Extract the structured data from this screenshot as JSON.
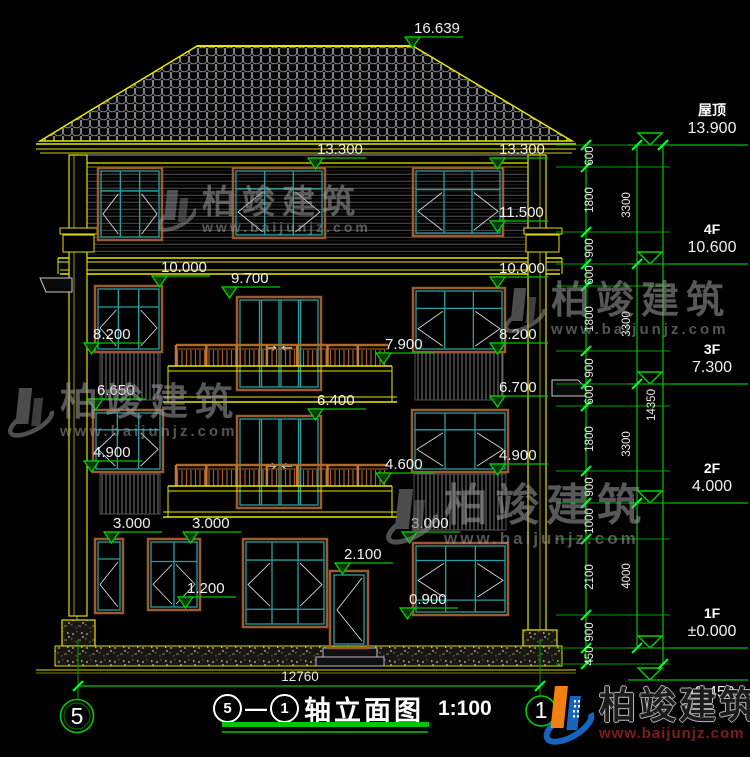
{
  "page": {
    "background": "#000000"
  },
  "title": {
    "axis_from": "5",
    "axis_to": "1",
    "separator": "—",
    "name": "轴立面图",
    "scale": "1:100"
  },
  "watermark": {
    "brand": "柏竣建筑",
    "url": "www.baijunjz.com"
  },
  "footer_logo": {
    "brand": "柏竣建筑",
    "url": "www.baijunjz.com"
  },
  "colors": {
    "dimension_green": "#00c400",
    "outline_yellow": "#e8e800",
    "window_teal": "#28a0a0",
    "frame_brown": "#9c5a30",
    "railing_brown": "#b06a28",
    "text_white": "#f0f0f0"
  },
  "drawing": {
    "bottom_dim": "12760",
    "axis_bubbles": {
      "left": "5",
      "right": "1"
    },
    "elevation_marks": [
      {
        "label": "16.639",
        "x": 405,
        "y": 37
      },
      {
        "label": "13.300",
        "x": 308,
        "y": 158
      },
      {
        "label": "13.300",
        "x": 490,
        "y": 158
      },
      {
        "label": "11.500",
        "x": 490,
        "y": 221
      },
      {
        "label": "10.000",
        "x": 152,
        "y": 276
      },
      {
        "label": "10.000",
        "x": 490,
        "y": 277
      },
      {
        "label": "9.700",
        "x": 222,
        "y": 287
      },
      {
        "label": "8.200",
        "x": 84,
        "y": 343
      },
      {
        "label": "8.200",
        "x": 490,
        "y": 343
      },
      {
        "label": "7.900",
        "x": 376,
        "y": 353
      },
      {
        "label": "6.650",
        "x": 88,
        "y": 399
      },
      {
        "label": "6.700",
        "x": 490,
        "y": 396
      },
      {
        "label": "6.400",
        "x": 308,
        "y": 409
      },
      {
        "label": "4.900",
        "x": 84,
        "y": 461
      },
      {
        "label": "4.600",
        "x": 376,
        "y": 473
      },
      {
        "label": "4.900",
        "x": 490,
        "y": 464
      },
      {
        "label": "3.000",
        "x": 104,
        "y": 532
      },
      {
        "label": "3.000",
        "x": 183,
        "y": 532
      },
      {
        "label": "3.000",
        "x": 402,
        "y": 532
      },
      {
        "label": "2.100",
        "x": 335,
        "y": 563
      },
      {
        "label": "1.200",
        "x": 178,
        "y": 597
      },
      {
        "label": "0.900",
        "x": 400,
        "y": 608
      }
    ],
    "right_levels": [
      {
        "floor": "屋顶",
        "elev": "13.900",
        "y": 145
      },
      {
        "floor": "4F",
        "elev": "10.600",
        "y": 264
      },
      {
        "floor": "3F",
        "elev": "7.300",
        "y": 384
      },
      {
        "floor": "2F",
        "elev": "4.000",
        "y": 503
      },
      {
        "floor": "1F",
        "elev": "±0.000",
        "y": 648
      },
      {
        "floor": "",
        "elev": "-0.450",
        "y": 680,
        "below": true
      }
    ],
    "dim_segments": [
      {
        "label": "600",
        "y": 156
      },
      {
        "label": "1800",
        "y": 200
      },
      {
        "label": "900",
        "y": 248
      },
      {
        "label": "600",
        "y": 275
      },
      {
        "label": "1800",
        "y": 319
      },
      {
        "label": "900",
        "y": 368
      },
      {
        "label": "600",
        "y": 395
      },
      {
        "label": "1800",
        "y": 439
      },
      {
        "label": "900",
        "y": 487
      },
      {
        "label": "1000",
        "y": 521
      },
      {
        "label": "2100",
        "y": 577
      },
      {
        "label": "900",
        "y": 632
      },
      {
        "label": "450",
        "y": 656
      }
    ],
    "dim_totals": [
      {
        "label": "3300",
        "y": 205
      },
      {
        "label": "3300",
        "y": 324
      },
      {
        "label": "3300",
        "y": 444
      },
      {
        "label": "4000",
        "y": 576
      }
    ],
    "dim_overall": {
      "label": "14350",
      "y": 405
    }
  }
}
